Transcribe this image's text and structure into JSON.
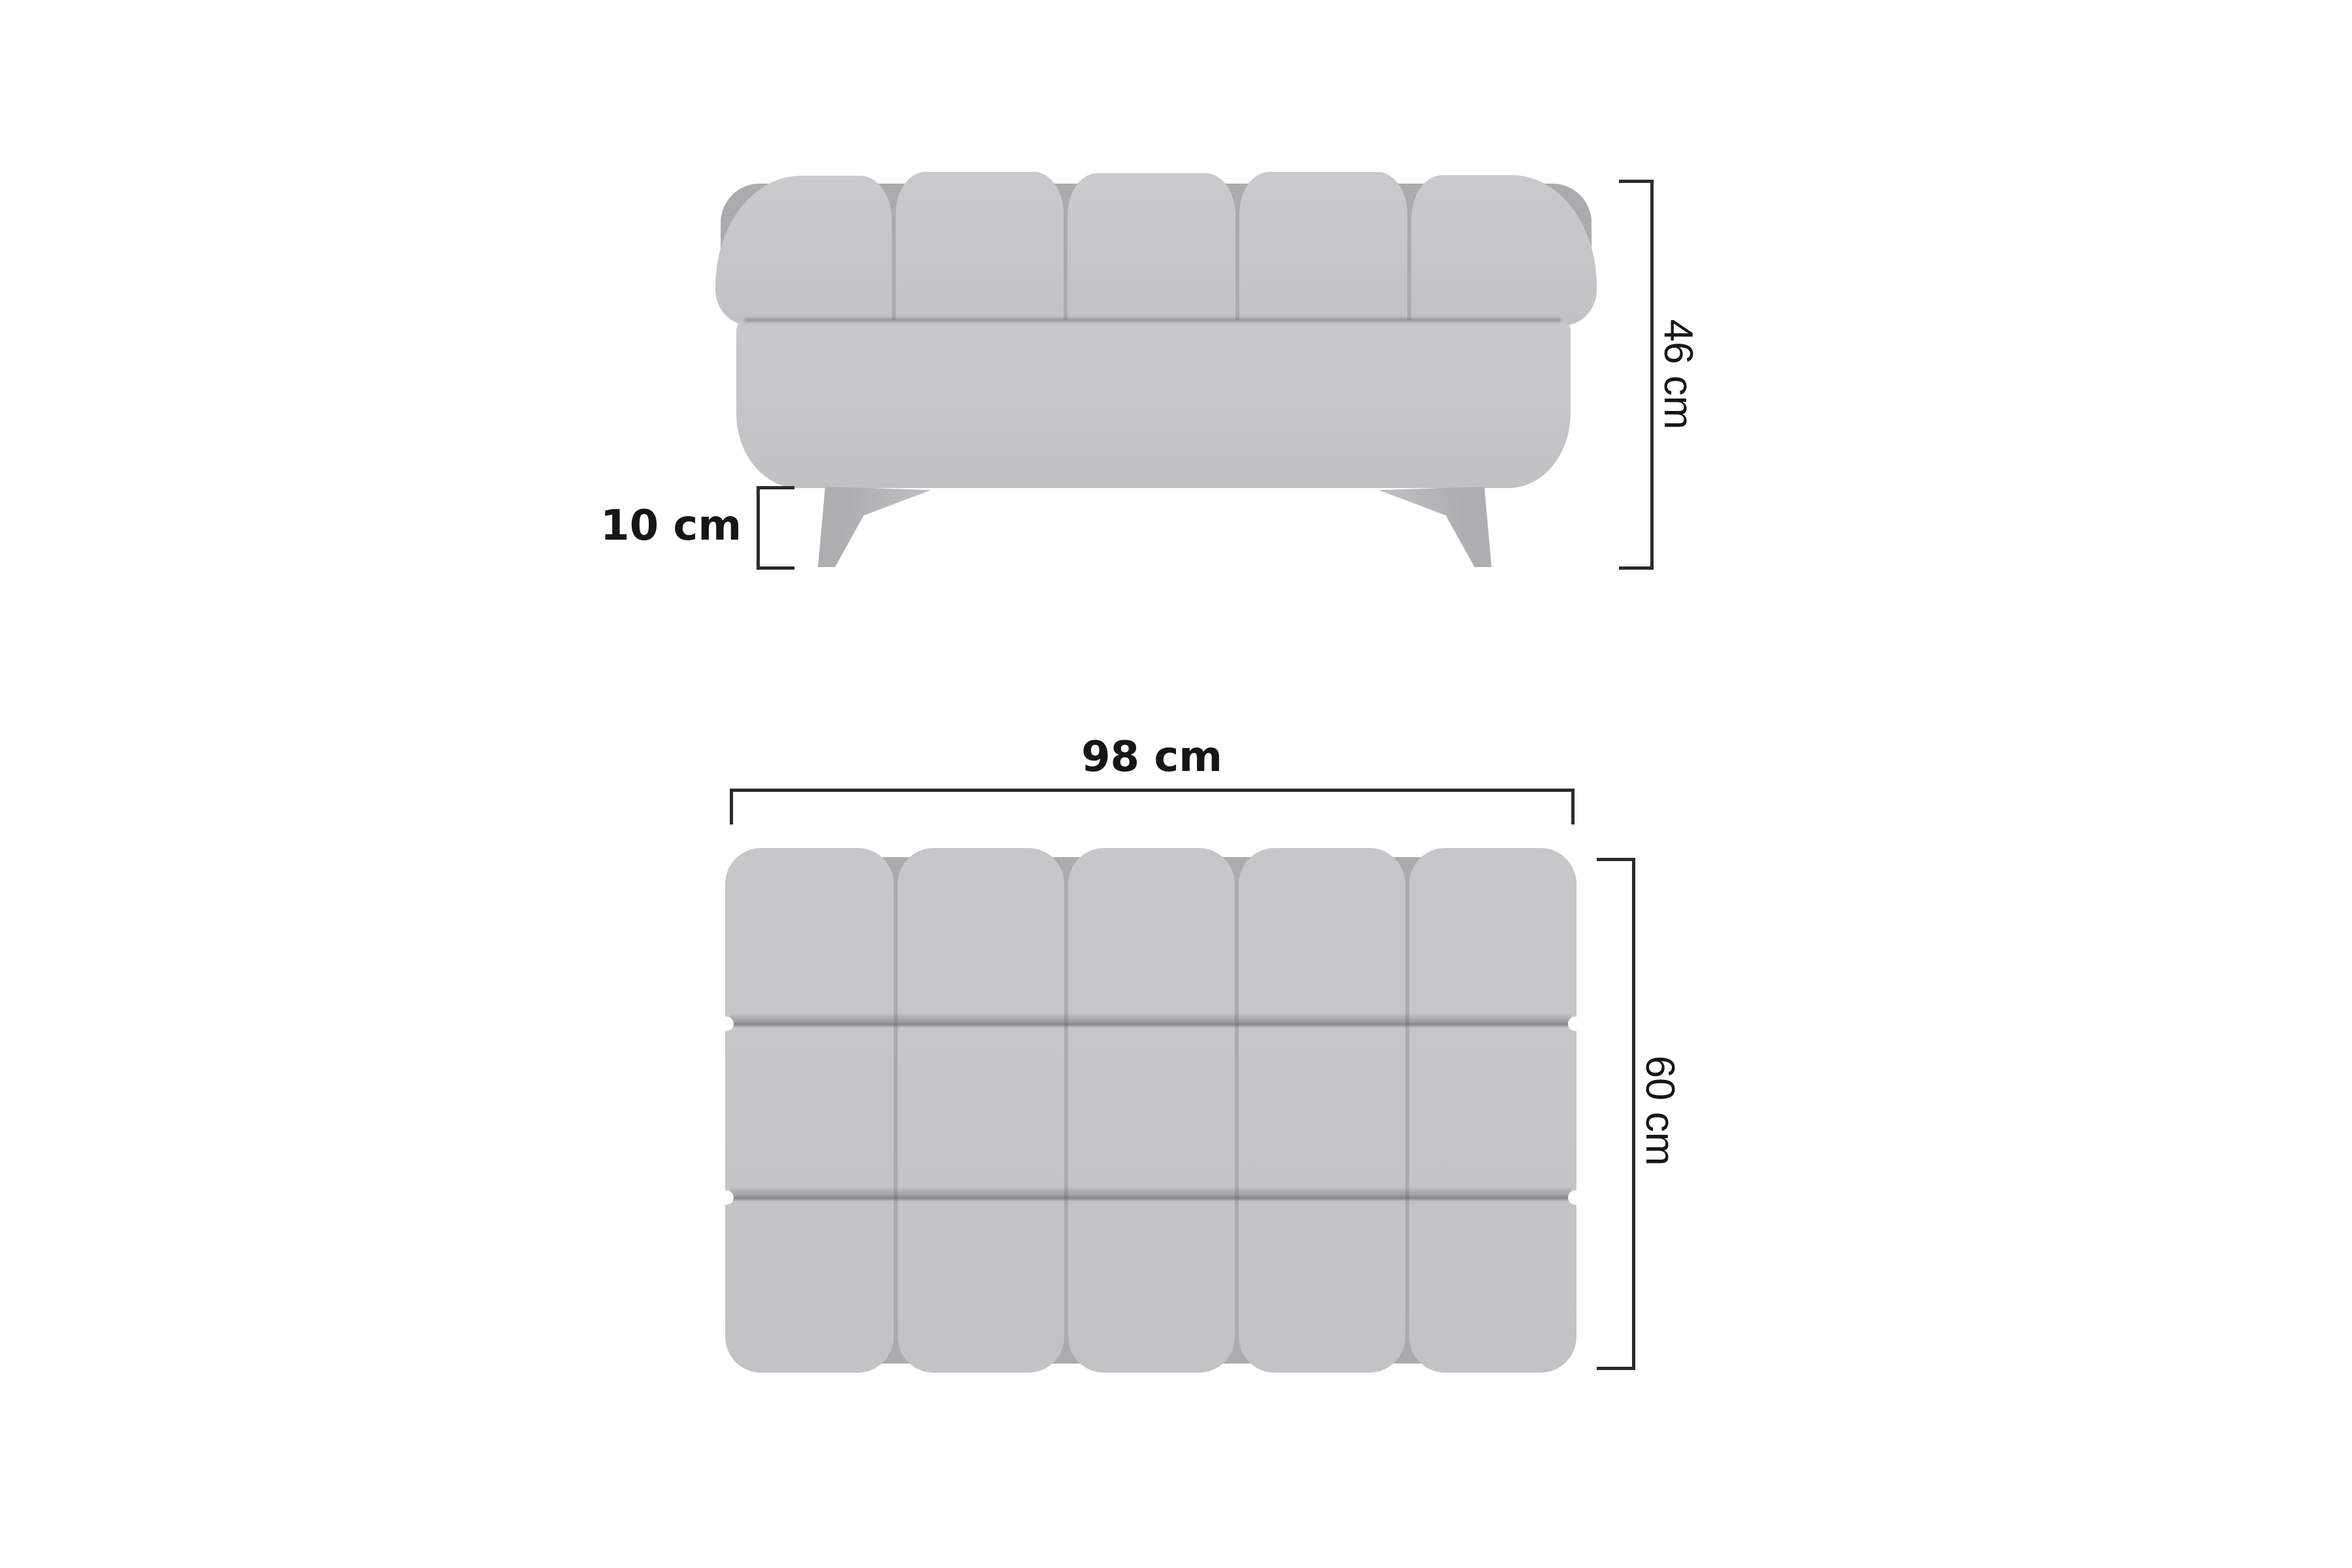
{
  "dimension_labels": {
    "front_total_height": "46 cm",
    "front_leg_height": "10 cm",
    "top_width": "98 cm",
    "top_depth": "60 cm"
  },
  "colors": {
    "background": "#ffffff",
    "upholstery": "#c6c6c8",
    "upholstery_seam": "#ababad",
    "dimension_line": "#2b2b2b",
    "text": "#161616"
  }
}
